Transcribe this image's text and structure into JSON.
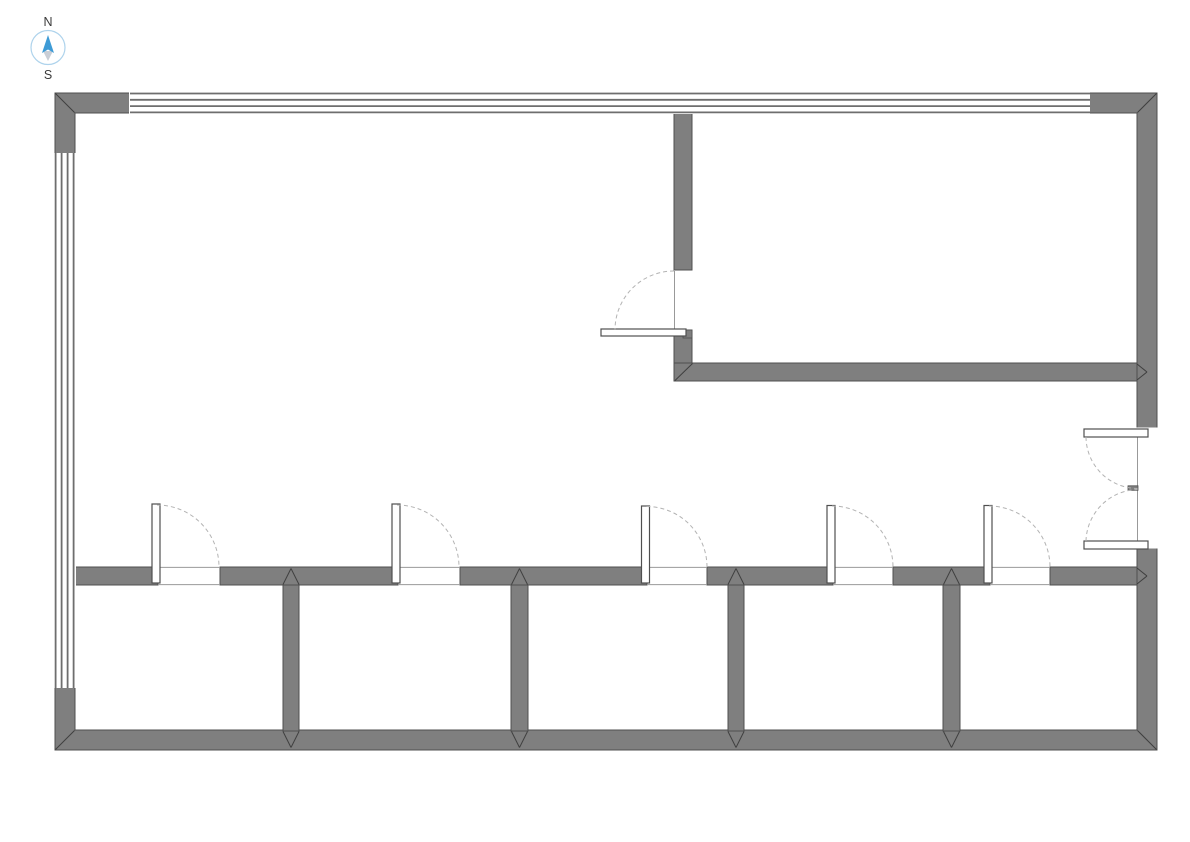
{
  "title": "floor-plan",
  "compass": {
    "north_label": "N",
    "south_label": "S",
    "cx": 48,
    "cy": 47.5,
    "r": 17,
    "circle_color": "#aed3ec",
    "north_arrow_color": "#3e9bd6",
    "south_arrow_color": "#c9ced6",
    "label_color": "#3a3a3a"
  },
  "colors": {
    "background": "#ffffff",
    "wall_fill": "#7f7f7f",
    "wall_edge": "#4f4f4f",
    "miter_line": "#3f3f3f",
    "window_line": "#6e6e6e",
    "opening_line": "#999999",
    "door_leaf_fill": "#ffffff",
    "door_leaf_edge": "#4f4f4f",
    "swing_arc": "#b3b3b3"
  },
  "plan": {
    "canvas": {
      "w": 1190,
      "h": 842
    },
    "frame": {
      "name": "exterior-wall",
      "path": "M55 93 H1157 V750 H55 Z M75 113 V730 H1137 V113 Z"
    },
    "walls": [
      {
        "name": "corridor-wall-seg-1",
        "r": [
          75,
          567,
          83,
          18
        ]
      },
      {
        "name": "corridor-wall-seg-2",
        "r": [
          220,
          567,
          178,
          18
        ]
      },
      {
        "name": "corridor-wall-seg-3",
        "r": [
          460,
          567,
          187,
          18
        ]
      },
      {
        "name": "corridor-wall-seg-4",
        "r": [
          707,
          567,
          126,
          18
        ]
      },
      {
        "name": "corridor-wall-seg-5",
        "r": [
          893,
          567,
          97,
          18
        ]
      },
      {
        "name": "corridor-wall-seg-6",
        "r": [
          1050,
          567,
          87,
          18
        ]
      },
      {
        "name": "room-divider-wall-1",
        "r": [
          283,
          585,
          16,
          146
        ]
      },
      {
        "name": "room-divider-wall-2",
        "r": [
          511,
          585,
          17,
          146
        ]
      },
      {
        "name": "room-divider-wall-3",
        "r": [
          728,
          585,
          16,
          146
        ]
      },
      {
        "name": "room-divider-wall-4",
        "r": [
          943,
          585,
          17,
          146
        ]
      },
      {
        "name": "upper-room-left-wall",
        "r": [
          674,
          113,
          18,
          157
        ]
      },
      {
        "name": "upper-room-left-wall-stub",
        "r": [
          674,
          330,
          18,
          51
        ]
      },
      {
        "name": "upper-room-bottom-wall",
        "r": [
          674,
          363,
          463,
          18
        ]
      }
    ],
    "windows": [
      {
        "name": "window-top",
        "cover": [
          129,
          92,
          961,
          22
        ],
        "lines": [
          [
            130,
            93.5,
            1090,
            93.5
          ],
          [
            130,
            99.8,
            1090,
            99.8
          ],
          [
            130,
            106.1,
            1090,
            106.1
          ],
          [
            130,
            112.4,
            1090,
            112.4
          ]
        ]
      },
      {
        "name": "window-left",
        "cover": [
          54,
          153,
          22,
          535
        ],
        "lines": [
          [
            55.6,
            153,
            55.6,
            688
          ],
          [
            61.6,
            153,
            61.6,
            688
          ],
          [
            67.6,
            153,
            67.6,
            688
          ],
          [
            73.6,
            153,
            73.6,
            688
          ]
        ]
      }
    ],
    "openings": [
      {
        "name": "entry-opening",
        "r": [
          1136,
          427.5,
          23,
          121
        ]
      }
    ],
    "opening_lines": [
      [
        158,
        567.4,
        220,
        567.4
      ],
      [
        398,
        567.4,
        460,
        567.4
      ],
      [
        647,
        567.4,
        707,
        567.4
      ],
      [
        833,
        567.4,
        893,
        567.4
      ],
      [
        990,
        567.4,
        1050,
        567.4
      ],
      [
        158,
        584.6,
        220,
        584.6
      ],
      [
        398,
        584.6,
        460,
        584.6
      ],
      [
        647,
        584.6,
        707,
        584.6
      ],
      [
        833,
        584.6,
        893,
        584.6
      ],
      [
        990,
        584.6,
        1050,
        584.6
      ],
      [
        674.5,
        271,
        674.5,
        330
      ],
      [
        1137.5,
        437,
        1137.5,
        541
      ]
    ],
    "miters": [
      [
        55.5,
        93.5,
        74.5,
        112.5
      ],
      [
        1156.5,
        93.5,
        1137.5,
        112.5
      ],
      [
        55.5,
        749.5,
        74.5,
        730.5
      ],
      [
        1156.5,
        749.5,
        1137.5,
        730.5
      ],
      [
        675,
        380.5,
        692.5,
        363.5
      ],
      [
        1137,
        364,
        1147,
        372
      ],
      [
        1137,
        380,
        1147,
        372
      ],
      [
        1137,
        568,
        1147,
        576
      ],
      [
        1137,
        584,
        1147,
        576
      ],
      [
        283,
        584.5,
        291,
        568.5
      ],
      [
        299,
        584.5,
        291,
        568.5
      ],
      [
        511.5,
        584.5,
        519.5,
        568.5
      ],
      [
        527.5,
        584.5,
        519.5,
        568.5
      ],
      [
        728,
        584.5,
        736,
        568.5
      ],
      [
        744,
        584.5,
        736,
        568.5
      ],
      [
        943.5,
        584.5,
        951.5,
        568.5
      ],
      [
        959.5,
        584.5,
        951.5,
        568.5
      ],
      [
        283,
        731.5,
        291,
        747.5
      ],
      [
        299,
        731.5,
        291,
        747.5
      ],
      [
        511.5,
        731.5,
        519.5,
        747.5
      ],
      [
        527.5,
        731.5,
        519.5,
        747.5
      ],
      [
        728,
        731.5,
        736,
        747.5
      ],
      [
        744,
        731.5,
        736,
        747.5
      ],
      [
        943.5,
        731.5,
        951.5,
        747.5
      ],
      [
        959.5,
        731.5,
        951.5,
        747.5
      ]
    ],
    "doors": [
      {
        "name": "room-door-1",
        "leafs": [
          [
            152,
            504,
            8,
            79
          ]
        ],
        "stubs": [],
        "arcs": [
          {
            "sx": 157,
            "sy": 505,
            "r": 62,
            "ex": 219,
            "ey": 567,
            "sweep": 1
          }
        ]
      },
      {
        "name": "room-door-2",
        "leafs": [
          [
            392,
            504,
            8,
            79
          ]
        ],
        "stubs": [],
        "arcs": [
          {
            "sx": 397,
            "sy": 505,
            "r": 62,
            "ex": 459,
            "ey": 567,
            "sweep": 1
          }
        ]
      },
      {
        "name": "room-door-3",
        "leafs": [
          [
            641.5,
            506,
            8,
            77
          ]
        ],
        "stubs": [],
        "arcs": [
          {
            "sx": 646.5,
            "sy": 506.5,
            "r": 60.5,
            "ex": 707,
            "ey": 567,
            "sweep": 1
          }
        ]
      },
      {
        "name": "room-door-4",
        "leafs": [
          [
            827,
            505.5,
            8,
            77.5
          ]
        ],
        "stubs": [],
        "arcs": [
          {
            "sx": 832,
            "sy": 506,
            "r": 61,
            "ex": 893,
            "ey": 567,
            "sweep": 1
          }
        ]
      },
      {
        "name": "room-door-5",
        "leafs": [
          [
            984,
            505.5,
            8,
            77.5
          ]
        ],
        "stubs": [],
        "arcs": [
          {
            "sx": 989,
            "sy": 506,
            "r": 61,
            "ex": 1050,
            "ey": 567,
            "sweep": 1
          }
        ]
      },
      {
        "name": "upper-room-door",
        "leafs": [
          [
            601,
            329,
            85,
            7
          ]
        ],
        "stubs": [
          [
            683,
            330,
            9,
            8
          ]
        ],
        "arcs": [
          {
            "sx": 674,
            "sy": 271,
            "r": 59,
            "ex": 615,
            "ey": 330,
            "sweep": 0
          }
        ]
      },
      {
        "name": "entry-double-door",
        "leafs": [
          [
            1084,
            429,
            64,
            8
          ],
          [
            1084,
            541,
            64,
            8
          ]
        ],
        "stubs": [
          [
            1141,
            429,
            7,
            8
          ],
          [
            1141,
            541,
            7,
            8
          ],
          [
            1128,
            485.8,
            10,
            4.5
          ]
        ],
        "arcs": [
          {
            "sx": 1086,
            "sy": 437,
            "r": 52,
            "ex": 1137.5,
            "ey": 488.5,
            "sweep": 0
          },
          {
            "sx": 1086,
            "sy": 541,
            "r": 53,
            "ex": 1137.5,
            "ey": 489.5,
            "sweep": 1
          }
        ]
      }
    ]
  }
}
